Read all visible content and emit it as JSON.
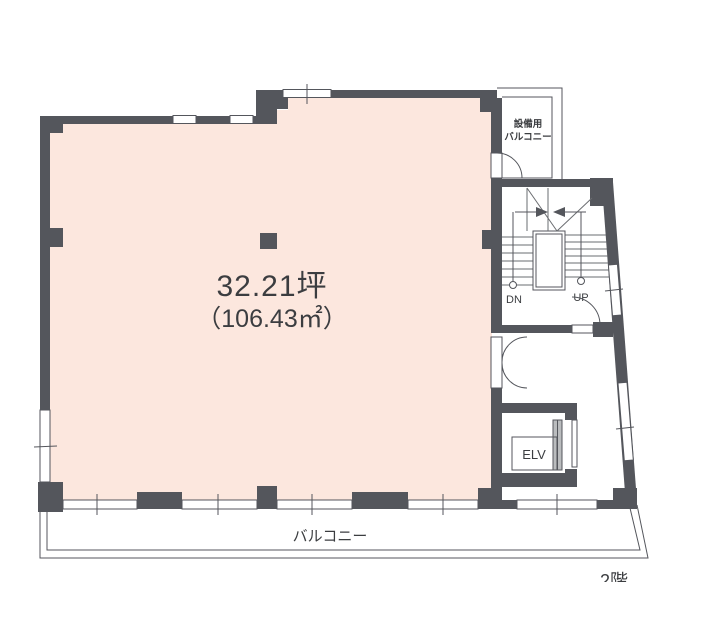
{
  "floor_plan": {
    "main_room": {
      "area_tsubo": "32.21坪",
      "area_sqm": "（106.43㎡）"
    },
    "equipment_balcony": {
      "label_line1": "設備用",
      "label_line2": "バルコニー"
    },
    "stairs": {
      "down_label": "DN",
      "up_label": "UP"
    },
    "elevator": {
      "label": "ELV"
    },
    "balcony": {
      "label": "バルコニー"
    },
    "floor_label": "2階"
  },
  "colors": {
    "room_fill": "#fce7de",
    "wall": "#54565c",
    "text": "#3b3d40",
    "background": "#ffffff"
  }
}
